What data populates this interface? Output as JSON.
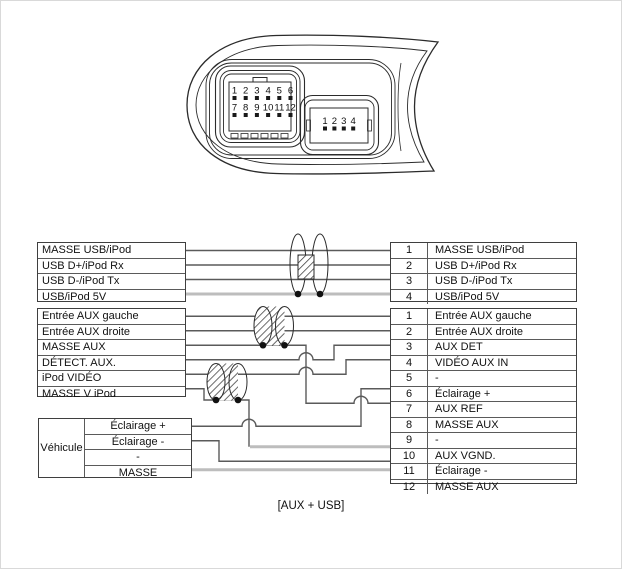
{
  "caption": "[AUX + USB]",
  "connector": {
    "plug_12pin": {
      "pins_row1": [
        "1",
        "2",
        "3",
        "4",
        "5",
        "6"
      ],
      "pins_row2": [
        "7",
        "8",
        "9",
        "10",
        "11",
        "12"
      ]
    },
    "plug_4pin": {
      "pins": [
        "1",
        "2",
        "3",
        "4"
      ]
    }
  },
  "tables": {
    "usb_left": {
      "rows": [
        "MASSE USB/iPod",
        "USB D+/iPod Rx",
        "USB D-/iPod Tx",
        "USB/iPod 5V"
      ]
    },
    "usb_right": {
      "rows": [
        {
          "pin": "1",
          "label": "MASSE USB/iPod"
        },
        {
          "pin": "2",
          "label": "USB D+/iPod Rx"
        },
        {
          "pin": "3",
          "label": "USB D-/iPod Tx"
        },
        {
          "pin": "4",
          "label": "USB/iPod 5V"
        }
      ]
    },
    "aux_left": {
      "rows": [
        "Entrée AUX gauche",
        "Entrée AUX droite",
        "MASSE AUX",
        "DÉTECT. AUX.",
        "iPod VIDÉO",
        "MASSE V iPod"
      ]
    },
    "aux_right": {
      "rows": [
        {
          "pin": "1",
          "label": "Entrée AUX gauche"
        },
        {
          "pin": "2",
          "label": "Entrée AUX droite"
        },
        {
          "pin": "3",
          "label": "AUX DET"
        },
        {
          "pin": "4",
          "label": "VIDÉO AUX IN"
        },
        {
          "pin": "5",
          "label": "-"
        },
        {
          "pin": "6",
          "label": "Éclairage +"
        },
        {
          "pin": "7",
          "label": "AUX REF"
        },
        {
          "pin": "8",
          "label": "MASSE AUX"
        },
        {
          "pin": "9",
          "label": "-"
        },
        {
          "pin": "10",
          "label": "AUX VGND."
        },
        {
          "pin": "11",
          "label": "Éclairage -"
        },
        {
          "pin": "12",
          "label": "MASSE AUX"
        }
      ]
    },
    "vehicule": {
      "header": "Véhicule",
      "rows": [
        "Éclairage +",
        "Éclairage -",
        "-",
        "MASSE"
      ]
    }
  },
  "connections": [
    {
      "from": "MASSE USB/iPod",
      "to_pin": "1",
      "style": "plain"
    },
    {
      "from": "USB D+/iPod Rx",
      "to_pin": "2",
      "style": "plain"
    },
    {
      "from": "USB D-/iPod Tx",
      "to_pin": "3",
      "style": "plain"
    },
    {
      "from": "USB/iPod 5V",
      "to_pin": "4",
      "style": "thick-gray"
    },
    {
      "from": "Entrée AUX gauche",
      "to_pin": "1",
      "style": "plain"
    },
    {
      "from": "Entrée AUX droite",
      "to_pin": "2",
      "style": "plain"
    },
    {
      "from": "MASSE AUX",
      "to_pin": "7",
      "style": "plain"
    },
    {
      "from": "DÉTECT. AUX.",
      "to_pin": "3",
      "style": "plain"
    },
    {
      "from": "iPod VIDÉO",
      "to_pin": "4",
      "style": "plain"
    },
    {
      "from": "MASSE V iPod",
      "to_pin": "10",
      "style": "plain-then-thick-gray"
    },
    {
      "from": "Véhicule Éclairage +",
      "to_pin": "6",
      "style": "plain"
    },
    {
      "from": "Véhicule Éclairage -",
      "to_pin": "11",
      "style": "plain"
    },
    {
      "from": "Véhicule MASSE",
      "to_pin": "12",
      "style": "thick-gray"
    }
  ],
  "shields": [
    {
      "around": [
        "USB D+/iPod Rx",
        "USB D-/iPod Tx"
      ],
      "drain_on": "USB/iPod 5V"
    },
    {
      "around": [
        "Entrée AUX gauche",
        "Entrée AUX droite"
      ],
      "drain_on": "MASSE AUX"
    },
    {
      "around": [
        "iPod VIDÉO"
      ],
      "drain_on": "MASSE V iPod"
    }
  ],
  "colors": {
    "wire": "#5a5a5a",
    "wire_thick_gray": "#bdbdbd",
    "outline": "#2b2b2b"
  }
}
